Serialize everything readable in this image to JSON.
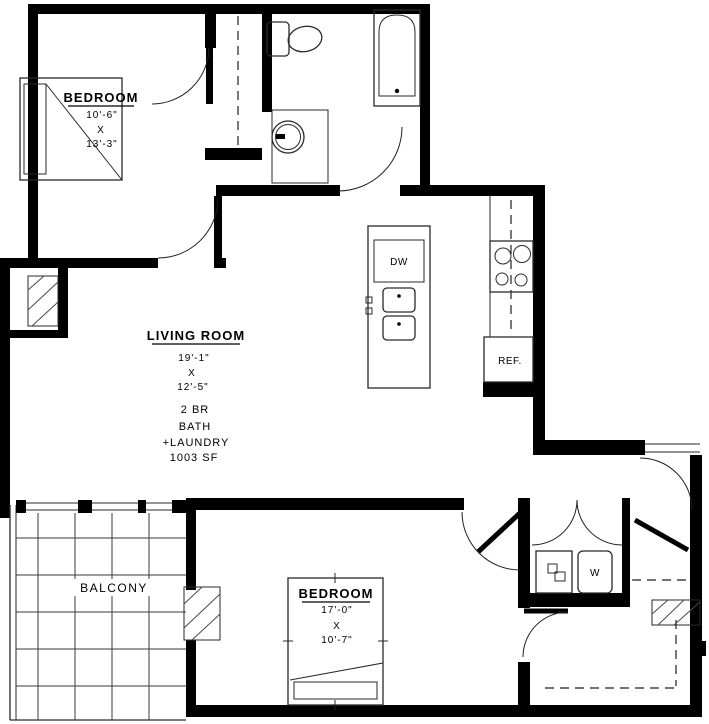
{
  "rooms": {
    "bedroom1": {
      "name": "BEDROOM",
      "width": "10'-6\"",
      "by": "X",
      "length": "13'-3\""
    },
    "living_room": {
      "name": "LIVING ROOM",
      "width": "19'-1\"",
      "by": "X",
      "length": "12'-5\"",
      "unit_type": "2 BR",
      "bath": "BATH",
      "laundry": "+LAUNDRY",
      "area": "1003 SF"
    },
    "bedroom2": {
      "name": "BEDROOM",
      "width": "17'-0\"",
      "by": "X",
      "length": "10'-7\""
    },
    "balcony": {
      "name": "BALCONY"
    }
  },
  "appliances": {
    "dishwasher": "DW",
    "refrigerator": "REF.",
    "washer": "W"
  },
  "colors": {
    "wall": "#000000",
    "fixture_line": "#2a2a2a",
    "background": "#ffffff"
  }
}
